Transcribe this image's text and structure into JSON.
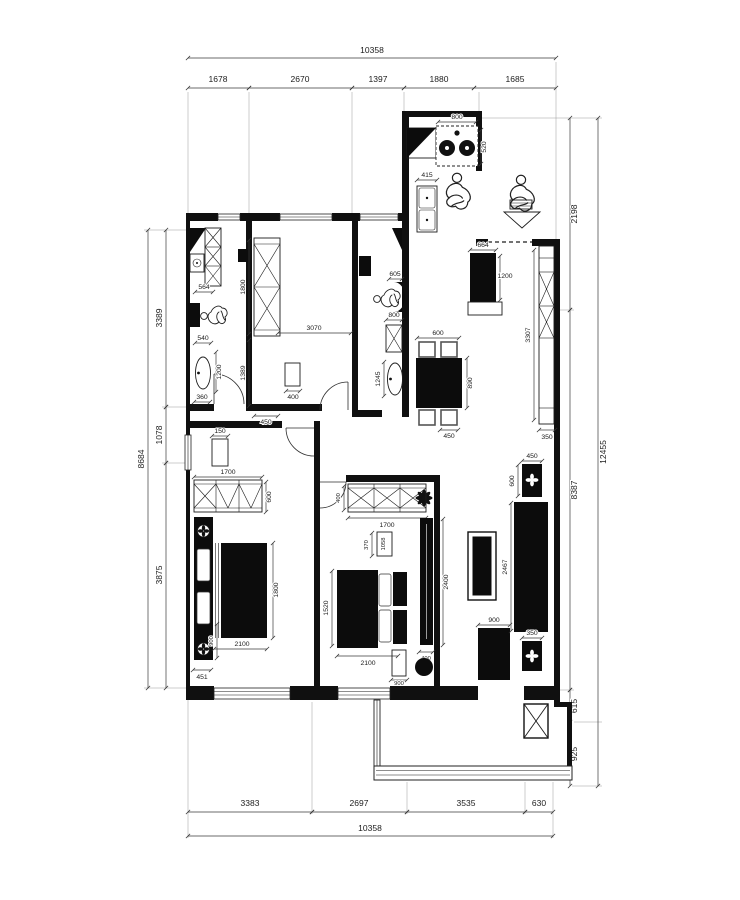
{
  "drawing": {
    "kind": "apartment floor plan",
    "background": "#ffffff",
    "ink": "#101010"
  },
  "dims_top": {
    "overall": "10358",
    "seg": [
      "1678",
      "2670",
      "1397",
      "1880",
      "1685"
    ]
  },
  "dims_bottom": {
    "overall": "10358",
    "seg": [
      "3383",
      "2697",
      "3535",
      "630"
    ]
  },
  "dims_left": {
    "overall": "8684",
    "seg": [
      "3389",
      "1078",
      "3875"
    ]
  },
  "dims_right": {
    "overall": "12455",
    "seg": [
      "2198",
      "8387",
      "615",
      "925"
    ]
  },
  "kitchen": {
    "stove": "800",
    "stove_depth": "520",
    "sink": "415"
  },
  "bath1": {
    "toilet_top": "564",
    "toilet_bottom": "540",
    "sink": "1200",
    "bottom": "360"
  },
  "bedroom_mid": {
    "wardrobe": "1800",
    "wall": "1389",
    "width": "3070",
    "stool": "400",
    "bottom": "450"
  },
  "bath2": {
    "top": "605",
    "toilet": "800",
    "sink": "1245"
  },
  "dining": {
    "width": "600",
    "length": "890",
    "chair": "450"
  },
  "entry": {
    "cabinet_w": "664",
    "cabinet_h": "1200"
  },
  "hall_cabinet": {
    "length": "3307",
    "depth": "350"
  },
  "living": {
    "sofa": "2467",
    "end_table_w": "450",
    "end_table_d": "600",
    "end_table2": "350",
    "tv_cabinet": "900"
  },
  "bedroom1": {
    "shelf": "150",
    "wardrobe": "1700",
    "wardrobe_d": "600",
    "bed_w": "1800",
    "bed_l": "2100",
    "nightstand": "900",
    "corner": "451"
  },
  "bedroom2": {
    "wardrobe": "1700",
    "wardrobe_d": "400",
    "desk": "370",
    "desk_label": "1058",
    "bed_w": "1520",
    "bed_l": "2100",
    "cabinet": "2400",
    "cabinet_w": "400",
    "bench": "900"
  }
}
